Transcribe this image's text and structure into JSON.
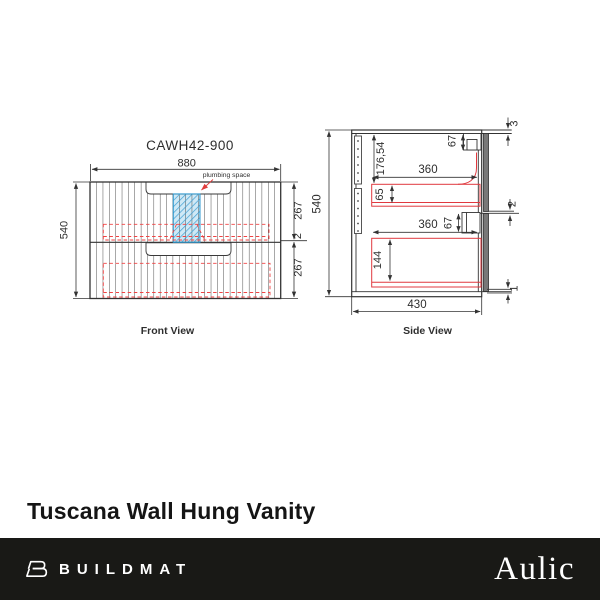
{
  "product": {
    "title": "Tuscana Wall Hung Vanity"
  },
  "footer": {
    "brand": "BUILDMAT",
    "vendor": "Aulic"
  },
  "front": {
    "model": "CAWH42-900",
    "view_label": "Front View",
    "plumbing_label": "plumbing space",
    "width": "880",
    "height": "540",
    "top_drawer_height": "267",
    "drawer_gap": "2",
    "bottom_drawer_height": "267"
  },
  "side": {
    "view_label": "Side View",
    "height": "540",
    "depth": "430",
    "top_clearance": "176,54",
    "top_drawer_depth": "360",
    "bottom_drawer_depth": "360",
    "top_runner_height": "67",
    "bottom_runner_height": "67",
    "top_drawer_inner_height": "65",
    "bottom_drawer_inner_height": "144",
    "top_gap": "3",
    "middle_gap": "2",
    "bottom_gap": "1"
  }
}
